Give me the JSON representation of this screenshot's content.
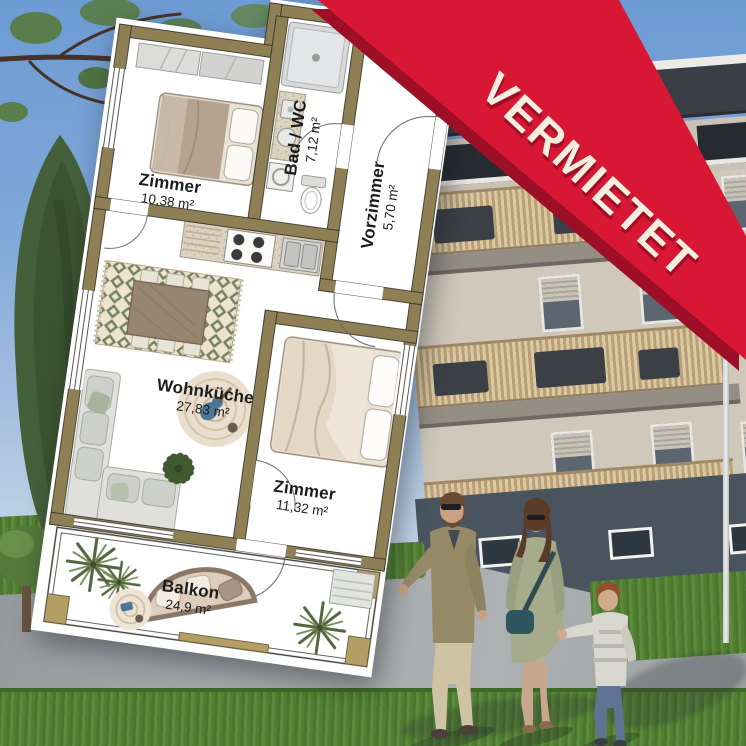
{
  "banner": {
    "label": "VERMIETET"
  },
  "colors": {
    "banner_red": "#d81734",
    "banner_shadow": "#9d0e27",
    "banner_text": "#f4eede",
    "wall": "#8e8054",
    "wall_trim": "#b59e63",
    "plan_paper": "#ffffff",
    "label_text": "#1c1c1c"
  },
  "floorplan": {
    "rooms": [
      {
        "key": "zimmer-1",
        "name": "Zimmer",
        "area": "10,38 m²"
      },
      {
        "key": "bad-wc",
        "name": "Bad / WC",
        "area": "7,12 m²"
      },
      {
        "key": "vorzimmer",
        "name": "Vorzimmer",
        "area": "5,70 m²"
      },
      {
        "key": "wohnkueche",
        "name": "Wohnküche",
        "area": "27,83 m²"
      },
      {
        "key": "zimmer-2",
        "name": "Zimmer",
        "area": "11,32 m²"
      },
      {
        "key": "balkon",
        "name": "Balkon",
        "area": "24,9 m²"
      }
    ]
  }
}
